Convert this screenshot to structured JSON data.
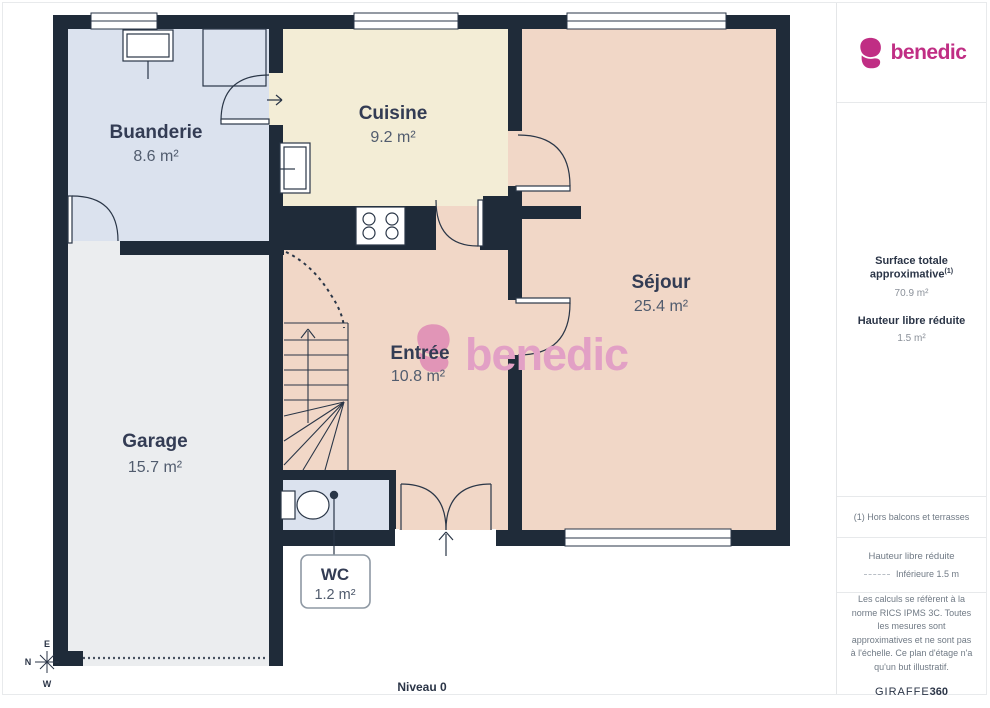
{
  "sidebar": {
    "brand": "benedic",
    "surface_title": "Surface totale approximative",
    "surface_sup": "(1)",
    "surface_value": "70.9 m²",
    "height_title": "Hauteur libre réduite",
    "height_value": "1.5 m²",
    "footnote": "(1) Hors balcons et terrasses",
    "legend_title": "Hauteur libre réduite",
    "legend_item": "Inférieure 1.5 m",
    "disclaimer": "Les calculs se réfèrent à la norme RICS IPMS 3C. Toutes les mesures sont approximatives et ne sont pas à l'échelle. Ce plan d'étage n'a qu'un but illustratif.",
    "brand_footer_1": "GIRAFFE",
    "brand_footer_2": "360"
  },
  "plan": {
    "level_label": "Niveau 0",
    "watermark": "benedic",
    "compass": {
      "e": "E",
      "n": "N",
      "w": "W"
    },
    "rooms": [
      {
        "id": "buanderie",
        "name": "Buanderie",
        "area": "8.6 m²"
      },
      {
        "id": "cuisine",
        "name": "Cuisine",
        "area": "9.2 m²"
      },
      {
        "id": "sejour",
        "name": "Séjour",
        "area": "25.4 m²"
      },
      {
        "id": "entree",
        "name": "Entrée",
        "area": "10.8 m²"
      },
      {
        "id": "garage",
        "name": "Garage",
        "area": "15.7 m²"
      },
      {
        "id": "wc",
        "name": "WC",
        "area": "1.2 m²"
      }
    ],
    "colors": {
      "wall": "#1f2b39",
      "buanderie": "#dbe2ee",
      "cuisine": "#f3edd6",
      "sejour_entree": "#f1d7c7",
      "garage": "#ebedef",
      "brand_pink": "#c02e84",
      "watermark_pink": "#dd8ab6"
    }
  }
}
